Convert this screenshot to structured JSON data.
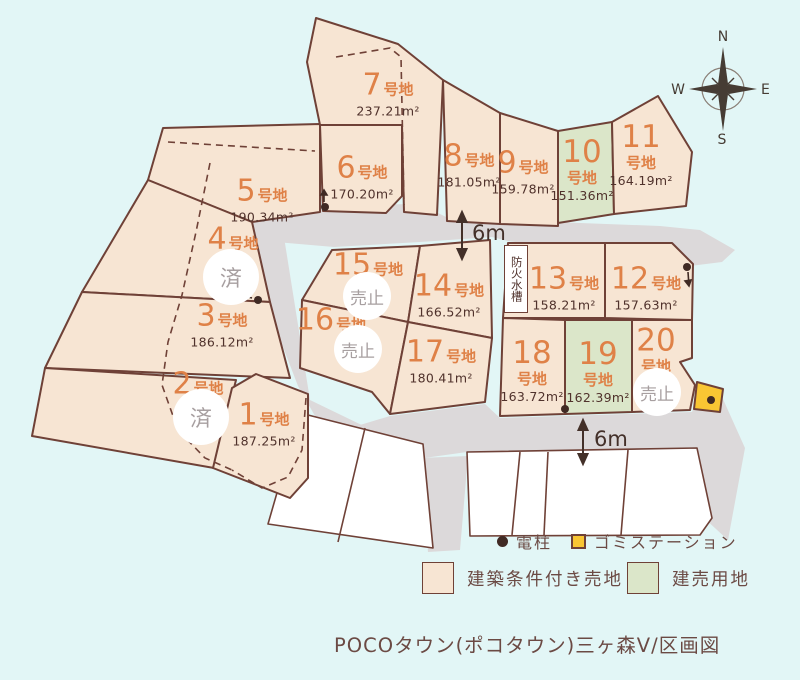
{
  "title": "POCOタウン(ポコタウン)三ヶ森V/区画図",
  "labels": {
    "lot_suffix": "号地",
    "sold": "済",
    "sale_stopped": "売止",
    "fire_tank": "防火水槽",
    "road_width": "6m"
  },
  "compass": {
    "n": "N",
    "e": "E",
    "s": "S",
    "w": "W"
  },
  "legend": {
    "pole": "電柱",
    "garbage_station": "ゴミステーション",
    "conditional_lot": "建築条件付き売地",
    "built_for_sale_lot": "建売用地"
  },
  "colors": {
    "background": "#e2f6f6",
    "lot_beige": "#f7e5d3",
    "lot_green": "#dbe6c9",
    "road_gray": "#dcd9da",
    "border_brown": "#6f4137",
    "number_orange": "#df8147",
    "area_brown": "#50322c",
    "status_gray": "#a79fa0",
    "garbage_yellow": "#f9c633"
  },
  "lots": [
    {
      "no": "1",
      "area": "187.25m²",
      "status": ""
    },
    {
      "no": "2",
      "area": "",
      "status": "済"
    },
    {
      "no": "3",
      "area": "186.12m²",
      "status": ""
    },
    {
      "no": "4",
      "area": "",
      "status": "済"
    },
    {
      "no": "5",
      "area": "190.34m²",
      "status": ""
    },
    {
      "no": "6",
      "area": "170.20m²",
      "status": ""
    },
    {
      "no": "7",
      "area": "237.21m²",
      "status": ""
    },
    {
      "no": "8",
      "area": "181.05m²",
      "status": ""
    },
    {
      "no": "9",
      "area": "159.78m²",
      "status": ""
    },
    {
      "no": "10",
      "area": "151.36m²",
      "status": ""
    },
    {
      "no": "11",
      "area": "164.19m²",
      "status": ""
    },
    {
      "no": "12",
      "area": "157.63m²",
      "status": ""
    },
    {
      "no": "13",
      "area": "158.21m²",
      "status": ""
    },
    {
      "no": "14",
      "area": "166.52m²",
      "status": ""
    },
    {
      "no": "15",
      "area": "",
      "status": "売止"
    },
    {
      "no": "16",
      "area": "",
      "status": "売止"
    },
    {
      "no": "17",
      "area": "180.41m²",
      "status": ""
    },
    {
      "no": "18",
      "area": "163.72m²",
      "status": ""
    },
    {
      "no": "19",
      "area": "162.39m²",
      "status": ""
    },
    {
      "no": "20",
      "area": "",
      "status": "売止"
    }
  ]
}
